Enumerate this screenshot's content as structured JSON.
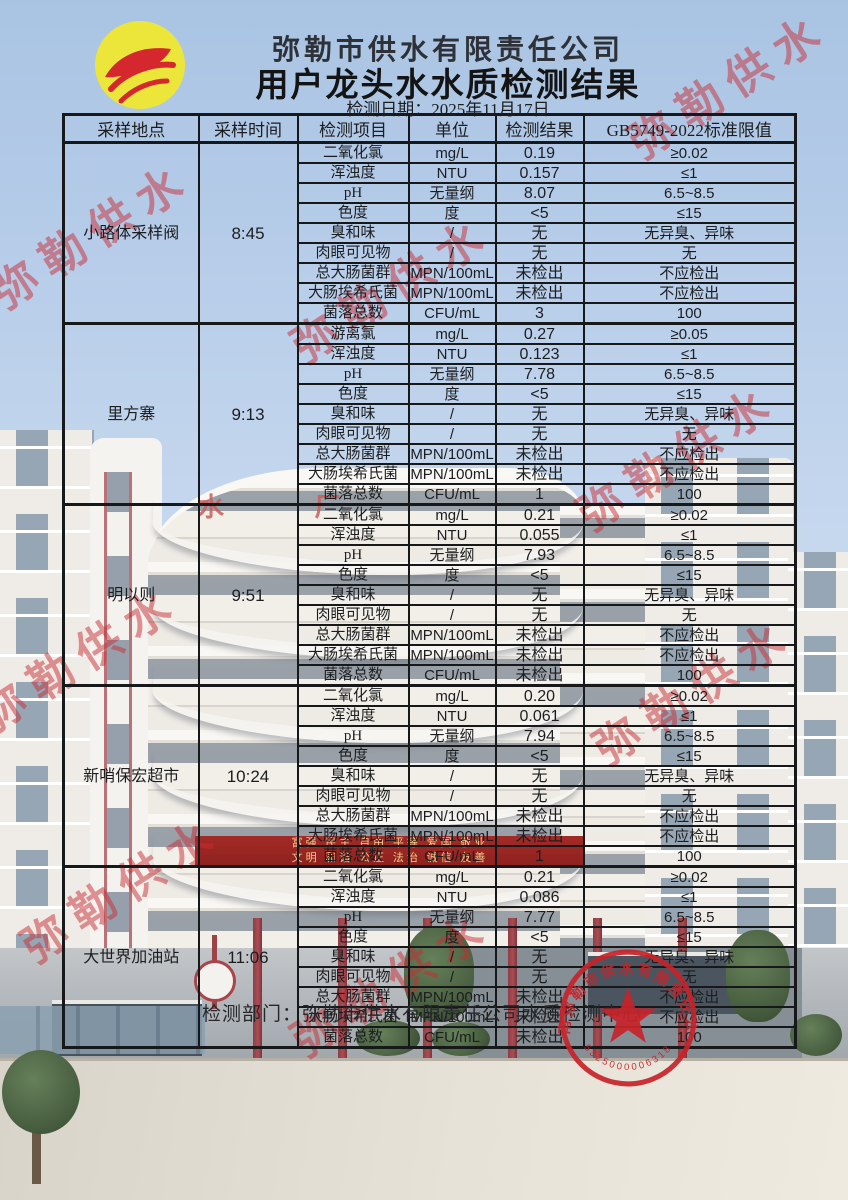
{
  "page": {
    "title_company": "弥勒市供水有限责任公司",
    "title_main": "用户龙头水水质检测结果",
    "date_line": "检测日期：2025年11月17日"
  },
  "table": {
    "columns": [
      "采样地点",
      "采样时间",
      "检测项目",
      "单位",
      "检测结果",
      "GB5749-2022标准限值"
    ],
    "sections": [
      {
        "location": "小路体采样阀",
        "time": "8:45",
        "rows": [
          [
            "二氧化氯",
            "mg/L",
            "0.19",
            "≥0.02"
          ],
          [
            "浑浊度",
            "NTU",
            "0.157",
            "≤1"
          ],
          [
            "pH",
            "无量纲",
            "8.07",
            "6.5~8.5"
          ],
          [
            "色度",
            "度",
            "<5",
            "≤15"
          ],
          [
            "臭和味",
            "/",
            "无",
            "无异臭、异味"
          ],
          [
            "肉眼可见物",
            "/",
            "无",
            "无"
          ],
          [
            "总大肠菌群",
            "MPN/100mL",
            "未检出",
            "不应检出"
          ],
          [
            "大肠埃希氏菌",
            "MPN/100mL",
            "未检出",
            "不应检出"
          ],
          [
            "菌落总数",
            "CFU/mL",
            "3",
            "100"
          ]
        ]
      },
      {
        "location": "里方寨",
        "time": "9:13",
        "rows": [
          [
            "游离氯",
            "mg/L",
            "0.27",
            "≥0.05"
          ],
          [
            "浑浊度",
            "NTU",
            "0.123",
            "≤1"
          ],
          [
            "pH",
            "无量纲",
            "7.78",
            "6.5~8.5"
          ],
          [
            "色度",
            "度",
            "<5",
            "≤15"
          ],
          [
            "臭和味",
            "/",
            "无",
            "无异臭、异味"
          ],
          [
            "肉眼可见物",
            "/",
            "无",
            "无"
          ],
          [
            "总大肠菌群",
            "MPN/100mL",
            "未检出",
            "不应检出"
          ],
          [
            "大肠埃希氏菌",
            "MPN/100mL",
            "未检出",
            "不应检出"
          ],
          [
            "菌落总数",
            "CFU/mL",
            "1",
            "100"
          ]
        ]
      },
      {
        "location": "明以则",
        "time": "9:51",
        "rows": [
          [
            "二氧化氯",
            "mg/L",
            "0.21",
            "≥0.02"
          ],
          [
            "浑浊度",
            "NTU",
            "0.055",
            "≤1"
          ],
          [
            "pH",
            "无量纲",
            "7.93",
            "6.5~8.5"
          ],
          [
            "色度",
            "度",
            "<5",
            "≤15"
          ],
          [
            "臭和味",
            "/",
            "无",
            "无异臭、异味"
          ],
          [
            "肉眼可见物",
            "/",
            "无",
            "无"
          ],
          [
            "总大肠菌群",
            "MPN/100mL",
            "未检出",
            "不应检出"
          ],
          [
            "大肠埃希氏菌",
            "MPN/100mL",
            "未检出",
            "不应检出"
          ],
          [
            "菌落总数",
            "CFU/mL",
            "未检出",
            "100"
          ]
        ]
      },
      {
        "location": "新哨保宏超市",
        "time": "10:24",
        "rows": [
          [
            "二氧化氯",
            "mg/L",
            "0.20",
            "≥0.02"
          ],
          [
            "浑浊度",
            "NTU",
            "0.061",
            "≤1"
          ],
          [
            "pH",
            "无量纲",
            "7.94",
            "6.5~8.5"
          ],
          [
            "色度",
            "度",
            "<5",
            "≤15"
          ],
          [
            "臭和味",
            "/",
            "无",
            "无异臭、异味"
          ],
          [
            "肉眼可见物",
            "/",
            "无",
            "无"
          ],
          [
            "总大肠菌群",
            "MPN/100mL",
            "未检出",
            "不应检出"
          ],
          [
            "大肠埃希氏菌",
            "MPN/100mL",
            "未检出",
            "不应检出"
          ],
          [
            "菌落总数",
            "CFU/mL",
            "1",
            "100"
          ]
        ]
      },
      {
        "location": "大世界加油站",
        "time": "11:06",
        "rows": [
          [
            "二氧化氯",
            "mg/L",
            "0.21",
            "≥0.02"
          ],
          [
            "浑浊度",
            "NTU",
            "0.086",
            "≤1"
          ],
          [
            "pH",
            "无量纲",
            "7.77",
            "6.5~8.5"
          ],
          [
            "色度",
            "度",
            "<5",
            "≤15"
          ],
          [
            "臭和味",
            "/",
            "无",
            "无异臭、异味"
          ],
          [
            "肉眼可见物",
            "/",
            "无",
            "无"
          ],
          [
            "总大肠菌群",
            "MPN/100mL",
            "未检出",
            "不应检出"
          ],
          [
            "大肠埃希氏菌",
            "MPN/100mL",
            "未检出",
            "不应检出"
          ],
          [
            "菌落总数",
            "CFU/mL",
            "未检出",
            "100"
          ]
        ]
      }
    ]
  },
  "footer": {
    "department_line": "检测部门：弥勒市供水有限责任公司水质检测中心"
  },
  "seal": {
    "arc_text": "云南弥勒市供水有限责任公司",
    "number": "5325000006318"
  },
  "watermark": {
    "text": "弥勒供水"
  },
  "background": {
    "roof_sign": "水 厂",
    "banner_line1": "富强 民主 自由 平等 爱国 敬业",
    "banner_line2": "文明 和谐 公正 法治 诚信 友善"
  },
  "colors": {
    "accent_red": "#c8232a",
    "logo_yellow": "#ece63a",
    "sky_blue": "#b7cde9"
  }
}
